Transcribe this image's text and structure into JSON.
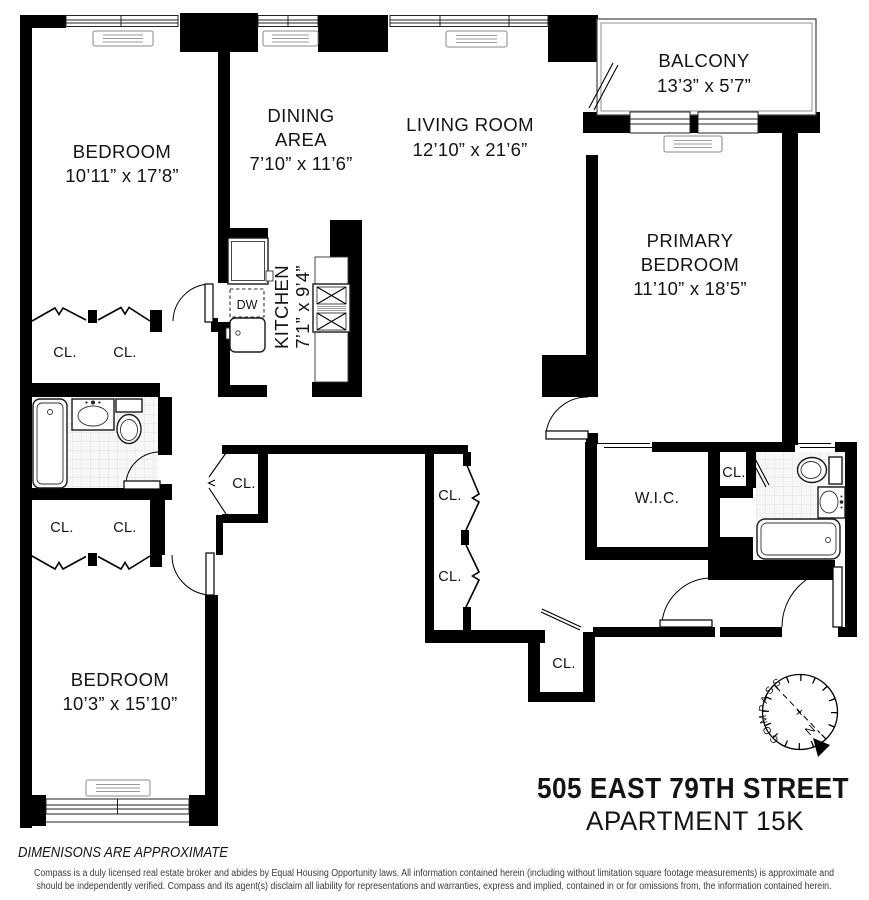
{
  "plan": {
    "rooms": {
      "bedroom_top": {
        "name": "BEDROOM",
        "dims": "10’11” x 17’8”"
      },
      "dining": {
        "line1": "DINING",
        "line2": "AREA",
        "dims": "7’10” x 11’6”"
      },
      "living": {
        "name": "LIVING ROOM",
        "dims": "12’10” x 21’6”"
      },
      "balcony": {
        "name": "BALCONY",
        "dims": "13’3” x 5’7”"
      },
      "primary": {
        "line1": "PRIMARY",
        "line2": "BEDROOM",
        "dims": "11’10” x 18’5”"
      },
      "kitchen": {
        "name": "KITCHEN",
        "dims": "7’1” x 9’4”"
      },
      "bedroom_bottom": {
        "name": "BEDROOM",
        "dims": "10’3” x 15’10”"
      },
      "wic": "W.I.C."
    },
    "labels": {
      "closet": "CL.",
      "dishwasher": "DW"
    },
    "compass": {
      "name": "COMPASS",
      "north": "N",
      "cross": "+"
    }
  },
  "title": {
    "line1": "505 EAST 79TH STREET",
    "line2": "APARTMENT 15K"
  },
  "footer": {
    "note": "DIMENISONS ARE APPROXIMATE",
    "disclaimer_line1": "Compass is a duly licensed real estate broker and abides by Equal Housing Opportunity laws.  All information contained herein (including without limitation square footage measurements) is approximate and",
    "disclaimer_line2": "should be independently verified. Compass and its agent(s) disclaim all liability for representations and warranties, express and implied, contained in or for omissions from, the information contained herein."
  }
}
